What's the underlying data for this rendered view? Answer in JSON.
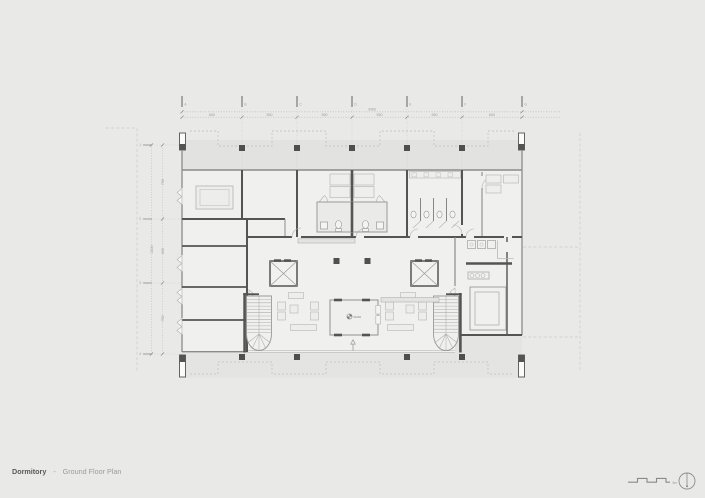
{
  "title": {
    "project": "Dormitory",
    "divider": "-",
    "view": "Ground Floor Plan"
  },
  "grid": {
    "cols": [
      "A",
      "B",
      "C",
      "D",
      "E",
      "F",
      "G"
    ],
    "rows": [
      "1",
      "2",
      "3",
      "4"
    ]
  },
  "dims": {
    "top_total": "3400",
    "top_segs": [
      "600",
      "550",
      "550",
      "550",
      "550",
      "600"
    ],
    "left_total": "2100",
    "left_segs": [
      "750",
      "600",
      "750"
    ]
  },
  "annotations": {
    "level": "±0.00",
    "scale": "5m"
  },
  "colors": {
    "background": "#e9e9e8",
    "wall_dark": "#545453",
    "line_medium": "#8b8b8a",
    "line_light": "#b9b9b7",
    "interior": "#f0f0ef",
    "terrace": "#e2e2e1",
    "text": "#9b9b9a",
    "title_text": "#5a5a59"
  }
}
